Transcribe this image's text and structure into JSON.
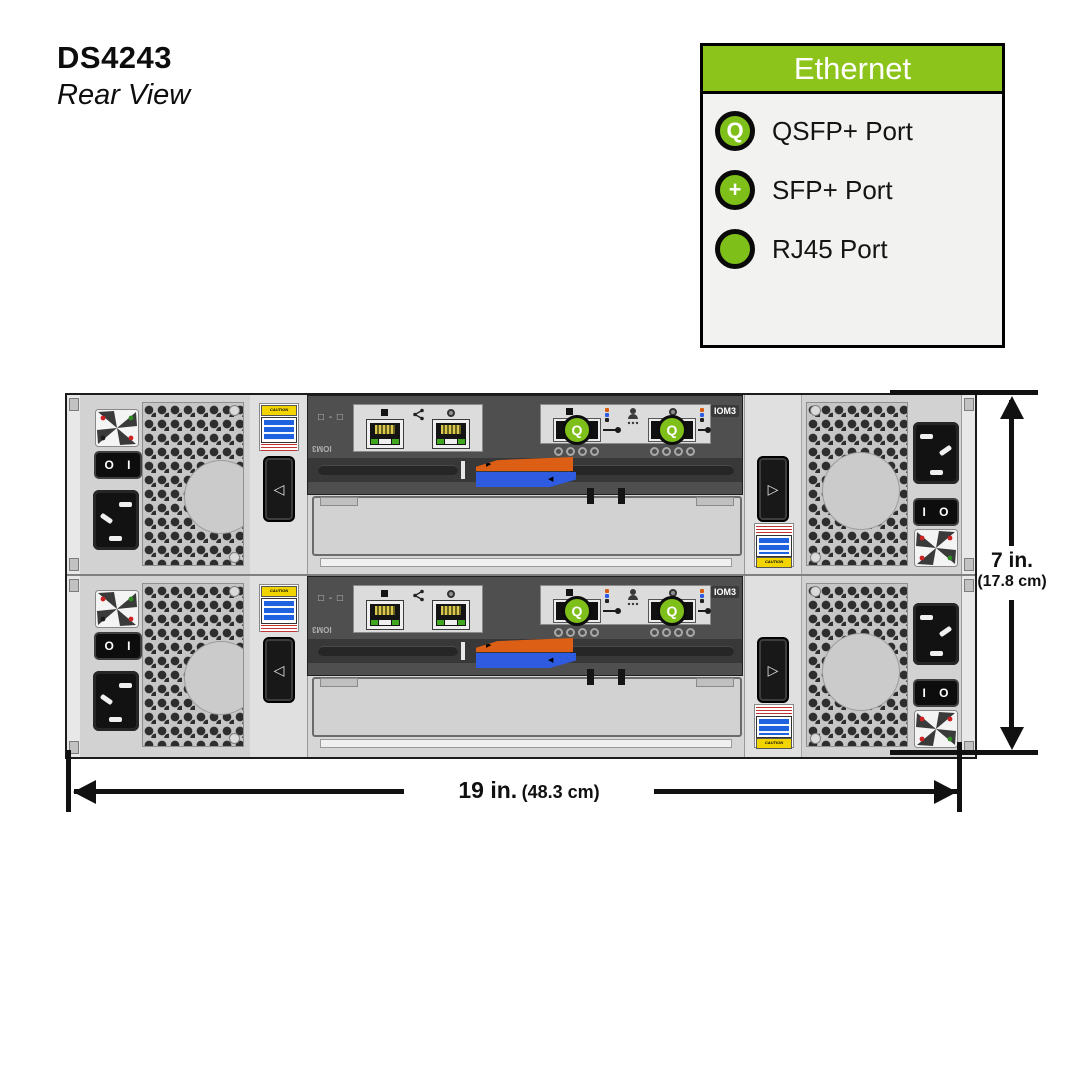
{
  "title": {
    "model": "DS4243",
    "view": "Rear View"
  },
  "legend": {
    "header": "Ethernet",
    "items": [
      {
        "symbol": "Q",
        "label": "QSFP+ Port"
      },
      {
        "symbol": "+",
        "label": "SFP+ Port"
      },
      {
        "symbol": "",
        "label": "RJ45 Port"
      }
    ]
  },
  "dimensions": {
    "height_label": "7 in.",
    "height_metric": "(17.8 cm)",
    "width_label": "19 in.",
    "width_metric": "(48.3 cm)"
  },
  "module": {
    "iom_label": "IOM3",
    "iom_label_rotated": "IOM3",
    "shelf_id_label": "□ - □",
    "qsfp_symbol": "Q"
  },
  "psu": {
    "switch_left": "O I",
    "switch_right": "I O"
  },
  "labels": {
    "caution": "CAUTION"
  },
  "icons": {
    "latch_left": "◁",
    "latch_right": "▷",
    "lever_right": "▶",
    "lever_left": "◀"
  },
  "colors": {
    "legend_green": "#8CC41C",
    "port_green": "#7FBF1A",
    "lever_orange": "#DD5E15",
    "lever_blue": "#2F5BE0"
  }
}
